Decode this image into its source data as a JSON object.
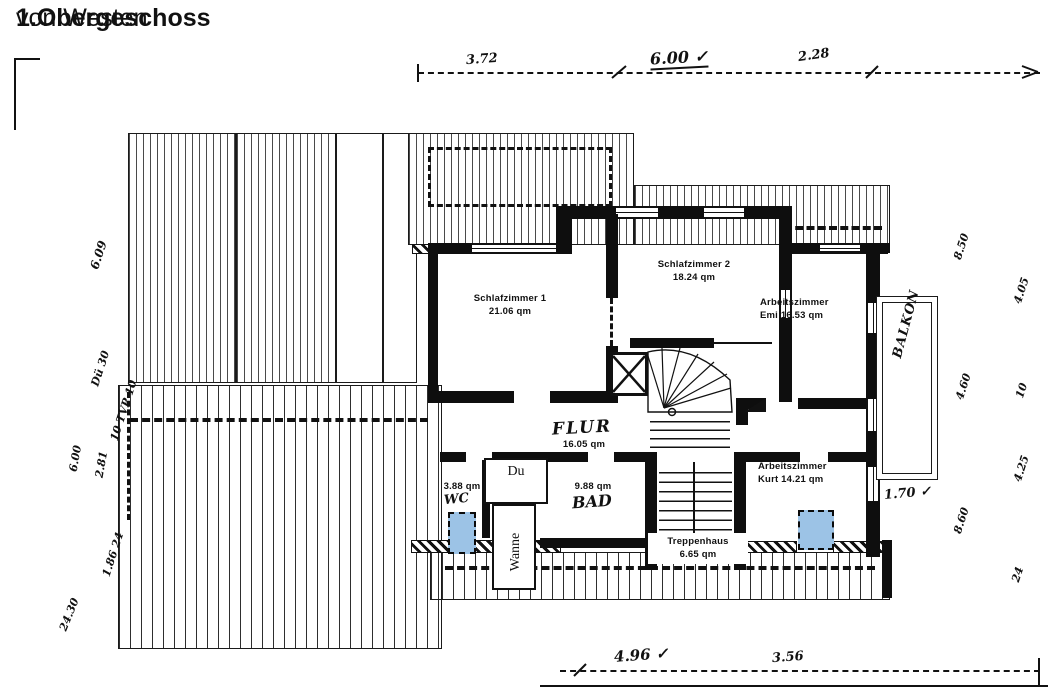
{
  "title": {
    "main": "1.Obergeschoss",
    "suffix": " von Westen"
  },
  "rooms": {
    "schlafzimmer1": {
      "name": "Schlafzimmer 1",
      "area": "21.06 qm"
    },
    "schlafzimmer2": {
      "name": "Schlafzimmer 2",
      "area": "18.24 qm"
    },
    "arbeitszimmer_emi": {
      "name": "Arbeitszimmer",
      "area": "Emi 16.53 qm"
    },
    "flur": {
      "name": "FLUR",
      "area": "16.05 qm"
    },
    "wc": {
      "name": "WC",
      "area": "3.88 qm"
    },
    "bad": {
      "name": "BAD",
      "area": "9.88 qm"
    },
    "dusche": {
      "name": "Du"
    },
    "wanne": {
      "name": "Wanne"
    },
    "treppenhaus": {
      "name": "Treppenhaus",
      "area": "6.65 qm"
    },
    "arbeitszimmer_kurt": {
      "name": "Arbeitszimmer",
      "area": "Kurt 14.21 qm"
    },
    "balkon": {
      "name": "BALKON"
    }
  },
  "dimensions": {
    "top": [
      "3.72",
      "6.00 ✓",
      "2.28"
    ],
    "bottom": [
      "4.96 ✓",
      "3.56"
    ],
    "balkon_width": "1.70 ✓",
    "left": [
      "6.09",
      "Dü 30",
      "10 TVP 10",
      "6.00",
      "2.81",
      "1.86 24",
      "24.30"
    ],
    "right": [
      "8.50",
      "4.05",
      "4.60",
      "10",
      "4.25",
      "8.60",
      "24"
    ]
  },
  "colors": {
    "ink": "#111111",
    "window_marker_blue": "#9cc3e6"
  }
}
